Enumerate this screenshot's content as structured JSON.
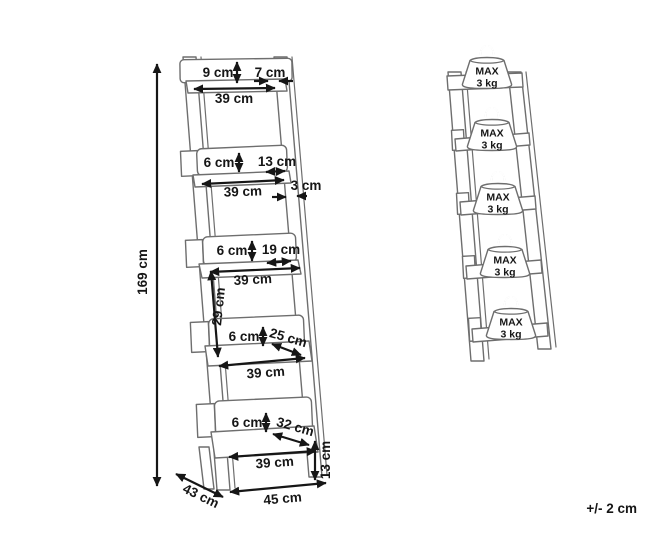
{
  "figure": {
    "tolerance_note": "+/- 2 cm",
    "load_badge": {
      "line1": "MAX",
      "line2": "3 kg"
    },
    "dimensions": {
      "overall_height": "169 cm",
      "top_shelf_back_height": "9 cm",
      "top_shelf_side_gap": "7 cm",
      "top_shelf_width": "39 cm",
      "shelf2_back_height": "6 cm",
      "shelf2_depth": "13 cm",
      "shelf2_width": "39 cm",
      "frame_thickness": "3 cm",
      "shelf3_back_height": "6 cm",
      "shelf3_depth": "19 cm",
      "shelf3_width": "39 cm",
      "shelf_spacing": "29 cm",
      "shelf4_back_height": "6 cm",
      "shelf4_depth": "25 cm",
      "shelf4_width": "39 cm",
      "shelf5_back_height": "6 cm",
      "shelf5_depth": "32 cm",
      "shelf5_width": "39 cm",
      "base_height": "13 cm",
      "base_depth": "43 cm",
      "base_width": "45 cm"
    }
  }
}
